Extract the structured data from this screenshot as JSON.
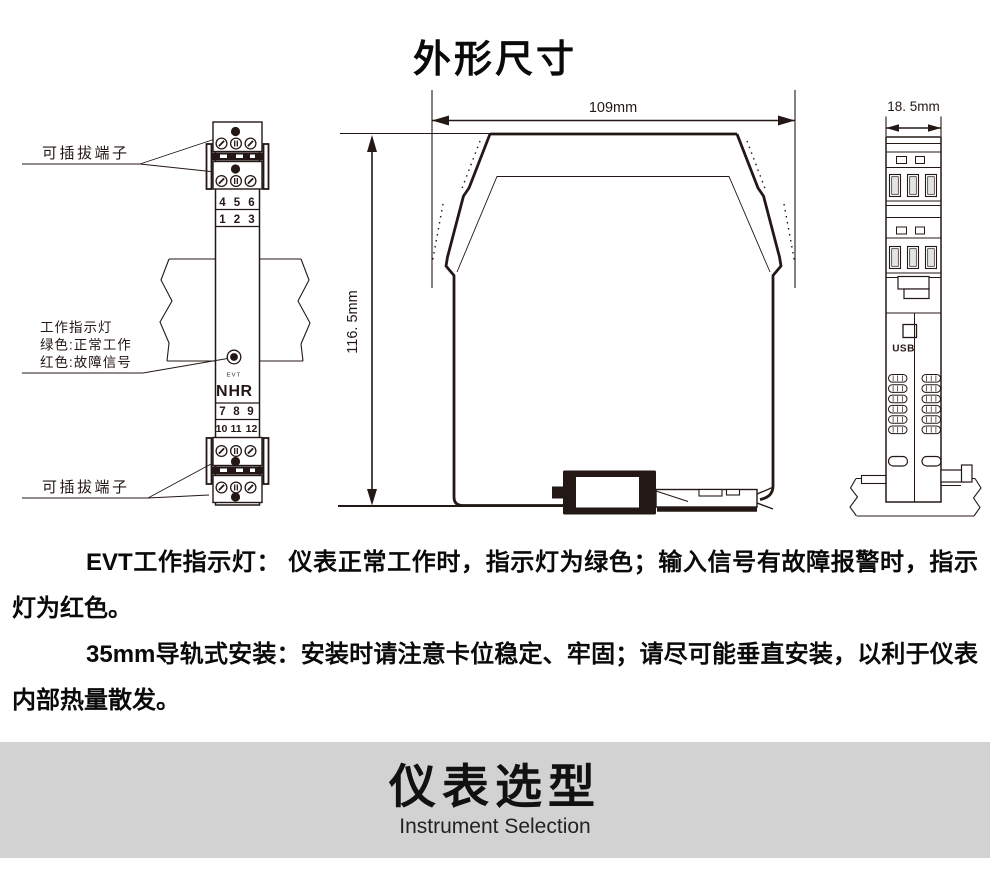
{
  "page": {
    "title": "外形尺寸"
  },
  "panel_view": {
    "terminal_label_top": "可插拔端子",
    "terminal_label_bottom": "可插拔端子",
    "indicator_label": [
      "工作指示灯",
      "绿色:正常工作",
      "红色:故障信号"
    ],
    "terminals_456": [
      "4",
      "5",
      "6"
    ],
    "terminals_123": [
      "1",
      "2",
      "3"
    ],
    "terminals_789": [
      "7",
      "8",
      "9"
    ],
    "terminals_101112": [
      "10",
      "11",
      "12"
    ],
    "led_label": "EVT",
    "logo": [
      "N",
      "H",
      "R"
    ]
  },
  "dimension_view": {
    "width_dim": "109mm",
    "height_dim": "116. 5mm"
  },
  "end_view": {
    "width_dim": "18. 5mm",
    "usb_label": "USB"
  },
  "notes": {
    "p1": "EVT工作指示灯： 仪表正常工作时，指示灯为绿色；输入信号有故障报警时，指示灯为红色。",
    "p2": "35mm导轨式安装：安装时请注意卡位稳定、牢固；请尽可能垂直安装，以利于仪表内部热量散发。"
  },
  "banner": {
    "title": "仪表选型",
    "subtitle": "Instrument Selection"
  },
  "colors": {
    "ink": "#231815",
    "red": "#e60012",
    "logo_red": "#c51f24",
    "banner_bg": "#d2d2d2"
  }
}
